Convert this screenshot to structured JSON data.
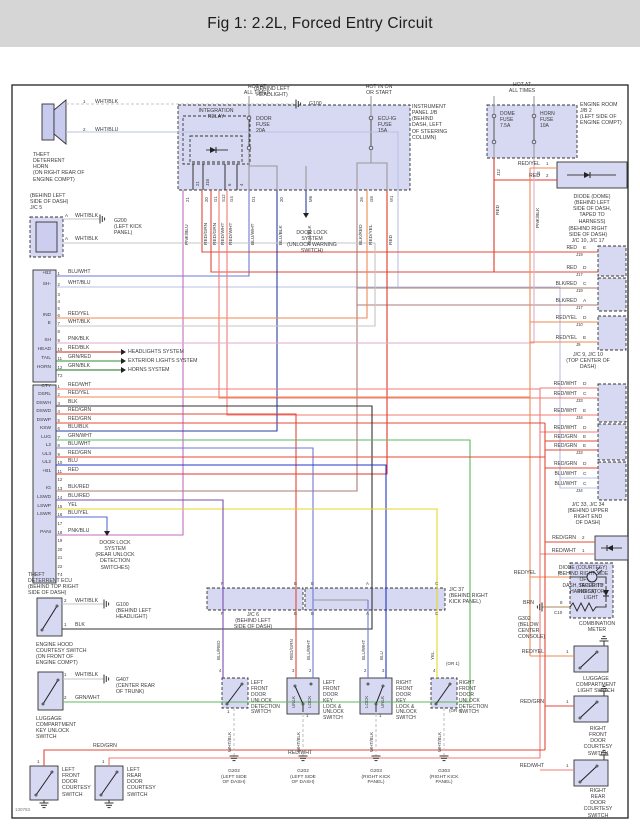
{
  "header": {
    "title": "Fig 1: 2.2L, Forced Entry Circuit"
  },
  "palette": {
    "RED": "#e03828",
    "RED_YEL": "#ef8a54",
    "RED_WHT": "#f27b72",
    "RED_GRN": "#e04838",
    "RED_BLK": "#c02818",
    "BLK_RED": "#ab7b76",
    "WHT_BLK": "#c4c4c4",
    "WHT_BLU": "#b9c2e2",
    "BLU_WHT": "#6b79d8",
    "BLU_BLK": "#2e3e9e",
    "BLU": "#2334c8",
    "BLU_RED": "#7a4fb2",
    "BLU_YEL": "#5a6ad0",
    "PNK_BLK": "#e2aec8",
    "PNK_BLU": "#c06ec0",
    "GRN_RED": "#2e8b2e",
    "GRN_BLK": "#1e6e1e",
    "GRN_WHT": "#5cb85c",
    "YEL": "#e8d428",
    "BLK": "#333333",
    "BRN": "#a88858",
    "GRY": "#9a9a9a",
    "DRK": "#444444",
    "boxfill": "#c9cbee",
    "frame": "#222222"
  },
  "diagram": {
    "code": "130793",
    "texts": {
      "t_horn": "THEFT\nDETERRENT\nHORN\n(ON RIGHT REAR OF\nENGINE COMPT)",
      "g100a_loc": "(BEHIND LEFT\nHEADLIGHT)",
      "g100a": "G100",
      "horn_p1": "1",
      "w_horn1": "WHT/BLK",
      "horn_p2": "2",
      "w_horn2": "WHT/BLU",
      "hot_door": "HOT AT\nALL TIMES",
      "hot_ecuig": "HOT IN ON\nOR START",
      "hot_dome": "HOT AT\nALL TIMES",
      "integ_relay": "INTEGRATION\nRELAY",
      "door_fuse": "DOOR\nFUSE\n20A",
      "ecuig_fuse": "ECU-IG\nFUSE\n15A",
      "dome_fuse": "DOME\nFUSE\n7.5A",
      "horn_fuse": "HORN\nFUSE\n10A",
      "ip_jb": "INSTRUMENT\nPANEL J/B\n(BEHIND\nDASH, LEFT\nOF STEERING\nCOLUMN)",
      "er_jb": "ENGINE ROOM\nJ/B 2\n(LEFT SIDE OF\nENGINE COMPT)",
      "dls1": "DOOR LOCK\nSYSTEM\n(UNLOCK WARNING\nSWITCH)",
      "dd_w1": "RED/YEL",
      "dd_p1": "1",
      "dd_w2": "RED",
      "dd_p2": "2",
      "diode_dome_lbl": "DIODE (DOME)\n(BEHIND LEFT\nSIDE OF DASH,\nTAPED TO\nHARNESS)",
      "brs_label": "(BEHIND RIGHT\nSIDE OF DASH)\nJ/C 10, J/C 17",
      "jc910_lbl": "J/C 9, J/C 10\n(TOP CENTER OF DASH)",
      "jc3334_lbl": "J/C 33, J/C 34\n(BEHIND UPPER\nRIGHT END\nOF DASH)",
      "dc_w1": "RED/GRN",
      "dc_p1": "2",
      "dc_w2": "RED/WHT",
      "dc_p2": "1",
      "dc_lbl": "DIODE (COURTESY)\n(BEHIND RIGHT SIDE OF\nDASH, TAPED TO HARNESS)",
      "sec_light": "SECURITY\nINDICATOR\nLIGHT",
      "comb_meter": "COMBINATION\nMETER",
      "sl_w": "RED/YEL",
      "sl_p": "9",
      "brn_w": "BRN",
      "brn_p": "8",
      "c10": "C10",
      "g302_lbl": "G302\n(BELOW\nCENTER\nCONSOLE)",
      "lls_w": "RED/YEL",
      "lls_p": "1",
      "lls_lbl": "LUGGAGE\nCOMPARTMENT\nLIGHT SWITCH",
      "rfc_w": "RED/GRN",
      "rfc_p": "1",
      "rfc_lbl": "RIGHT\nFRONT\nDOOR\nCOURTESY\nSWITCH",
      "rrc_w": "RED/WHT",
      "rrc_p": "1",
      "rrc_lbl": "RIGHT\nREAR\nDOOR\nCOURTESY\nSWITCH",
      "jc5_lbl": "(BEHIND LEFT\nSIDE OF DASH)\nJ/C 5",
      "jc5_p1": "A",
      "jc5_w1": "WHT/BLK",
      "g200_lbl": "G200\n(LEFT KICK\nPANEL)",
      "jc5_p2": "A",
      "jc5_w2": "WHT/BLK",
      "hl_sys": "HEADLIGHTS SYSTEM",
      "ext_sys": "EXTERIOR LIGHTS SYSTEM",
      "horn_sys": "HORNS SYSTEM",
      "dls2": "DOOR LOCK\nSYSTEM\n(REAR UNLOCK\nDETECTION\nSWITCHES)",
      "ecu_lbl": "THEFT\nDETERRENT ECU\n(BEHIND TOP RIGHT\nSIDE OF DASH)",
      "hood_p2": "2",
      "hood_w2": "WHT/BLK",
      "g100b_lbl": "G100\n(BEHIND LEFT\nHEADLIGHT)",
      "hood_p1": "1",
      "hood_w1": "BLK",
      "hood_lbl": "ENGINE HOOD\nCOURTESY SWITCH\n(ON FRONT OF\nENGINE COMPT)",
      "lugk_p1": "1",
      "lugk_w1": "WHT/BLK",
      "g407_lbl": "G407\n(CENTER REAR\nOF TRUNK)",
      "lugk_p2": "2",
      "lugk_w2": "GRN/WHT",
      "lugk_lbl": "LUGGAGE\nCOMPARTMENT\nKEY UNLOCK\nSWITCH",
      "rg_b": "RED/GRN",
      "rw_b": "RED/WHT",
      "lfc_p": "1",
      "lfc_lbl": "LEFT\nFRONT\nDOOR\nCOURTESY\nSWITCH",
      "lrc_p": "1",
      "lrc_lbl": "LEFT\nREAR\nDOOR\nCOURTESY\nSWITCH",
      "jc6_lbl": "J/C 6\n(BEHIND LEFT\nSIDE OF DASH)",
      "jc37_lbl": "J/C 37\n(BEHIND RIGHT\nKICK PANEL)",
      "or1": "(OR 1)",
      "or4": "(OR 4)",
      "det1_lbl": "LEFT\nFRONT\nDOOR\nUNLOCK\nDETECTION\nSWITCH",
      "key1_lbl": "LEFT\nFRONT\nDOOR\nKEY\nLOCK &\nUNLOCK\nSWITCH",
      "key2_lbl": "RIGHT\nFRONT\nDOOR\nKEY\nLOCK &\nUNLOCK\nSWITCH",
      "det2_lbl": "RIGHT\nFRONT\nDOOR\nUNLOCK\nDETECTION\nSWITCH",
      "det1_p": "1",
      "key1_p": "1",
      "key2_p": "1",
      "unlk1": "UNLK",
      "lock1": "LOCK",
      "lock2": "LOCK",
      "unlk2": "UNLK",
      "g202a_lbl": "G202\n(LEFT SIDE\nOF DASH)",
      "g202b_lbl": "G202\n(LEFT SIDE\nOF DASH)",
      "g203_lbl": "G203\n(RIGHT KICK\nPANEL)",
      "g303_lbl": "G303\n(RIGHT KICK\nPANEL)"
    },
    "jb": {
      "relay_pins": [
        "21",
        "J18",
        "6",
        "4"
      ],
      "exits": [
        {
          "pin": "21",
          "wire": "PNK/BLU"
        },
        {
          "pin": "20",
          "wire": "RED/GRN"
        },
        {
          "pin": "G1",
          "wire": "RED/GRN"
        },
        {
          "pin": "S12",
          "wire": "RED/WHT"
        },
        {
          "pin": "G4",
          "wire": "RED/WHT"
        },
        {
          "pin": "D1",
          "wire": "BLU/WHT"
        },
        {
          "pin": "20",
          "wire": "BLU/BLK"
        },
        {
          "pin": "M6",
          "wire": "BLU/BLK"
        },
        {
          "pin": "26",
          "wire": "BLK/RED"
        },
        {
          "pin": "G8",
          "wire": "RED/YEL"
        },
        {
          "pin": "W1",
          "wire": "RED"
        }
      ]
    },
    "er": {
      "exits": [
        {
          "pin": "J12",
          "wire": "RED"
        },
        {
          "pin": "12",
          "wire": "PNK/BLK"
        }
      ]
    },
    "ecu": {
      "conn1": [
        {
          "n": "1",
          "name": "+B2",
          "wire": "BLU/WHT"
        },
        {
          "n": "2",
          "name": "SH-",
          "wire": "WHT/BLU"
        },
        {
          "n": "3"
        },
        {
          "n": "4"
        },
        {
          "n": "5"
        },
        {
          "n": "6",
          "name": "IND",
          "wire": "RED/YEL"
        },
        {
          "n": "7",
          "name": "E",
          "wire": "WHT/BLK"
        },
        {
          "n": "8"
        },
        {
          "n": "9",
          "name": "SH",
          "wire": "PNK/BLK"
        },
        {
          "n": "10",
          "name": "HEAD",
          "wire": "RED/BLK"
        },
        {
          "n": "11",
          "name": "TAIL",
          "wire": "GRN/RED"
        },
        {
          "n": "12",
          "name": "HORN",
          "wire": "GRN/BLK"
        },
        {
          "n": "T2"
        }
      ],
      "conn2": [
        {
          "n": "1",
          "name": "CTY",
          "wire": "RED/WHT"
        },
        {
          "n": "2",
          "name": "DSRL",
          "wire": "RED/YEL"
        },
        {
          "n": "3",
          "name": "DSWH",
          "wire": "BLK"
        },
        {
          "n": "4",
          "name": "DSWD",
          "wire": "RED/GRN"
        },
        {
          "n": "5",
          "name": "DSWP",
          "wire": "RED/GRN"
        },
        {
          "n": "6",
          "name": "KSW",
          "wire": "BLU/BLK"
        },
        {
          "n": "7",
          "name": "LUG",
          "wire": "GRN/WHT"
        },
        {
          "n": "8",
          "name": "L2",
          "wire": "BLU/WHT"
        },
        {
          "n": "9",
          "name": "UL3",
          "wire": "RED/GRN"
        },
        {
          "n": "10",
          "name": "UL2",
          "wire": "BLU"
        },
        {
          "n": "11",
          "name": "+B1",
          "wire": "RED"
        },
        {
          "n": "12"
        },
        {
          "n": "13",
          "name": "IG",
          "wire": "BLK/RED"
        },
        {
          "n": "14",
          "name": "LSWD",
          "wire": "BLU/RED"
        },
        {
          "n": "15",
          "name": "LSWP",
          "wire": "YEL"
        },
        {
          "n": "16",
          "name": "LSWR",
          "wire": "BLU/YEL"
        },
        {
          "n": "17"
        },
        {
          "n": "18",
          "name": "PANI",
          "wire": "PNK/BLU"
        },
        {
          "n": "19"
        },
        {
          "n": "20"
        },
        {
          "n": "21"
        },
        {
          "n": "22"
        },
        {
          "n": "T4"
        }
      ]
    },
    "right": {
      "jc1017": [
        {
          "wire": "RED",
          "pin": "E",
          "tag": "J19"
        },
        {
          "wire": "RED",
          "pin": "D",
          "tag": "J17"
        },
        {
          "wire": "BLK/RED",
          "pin": "C",
          "tag": "J19"
        },
        {
          "wire": "BLK/RED",
          "pin": "A",
          "tag": "J17"
        }
      ],
      "jc910": [
        {
          "wire": "RED/YEL",
          "pin": "D",
          "tag": "J10"
        },
        {
          "wire": "RED/YEL",
          "pin": "E",
          "tag": "J9"
        }
      ],
      "jc3334": [
        {
          "wire": "RED/WHT",
          "pin": "D"
        },
        {
          "wire": "RED/WHT",
          "pin": "C",
          "tag": "J33"
        },
        {
          "wire": "RED/WHT",
          "pin": "E",
          "tag": "J34"
        },
        {
          "wire": "RED/WHT",
          "pin": "D"
        },
        {
          "wire": "RED/GRN",
          "pin": "E"
        },
        {
          "wire": "RED/GRN",
          "pin": "E",
          "tag": "J33"
        },
        {
          "wire": "RED/GRN",
          "pin": "D"
        },
        {
          "wire": "BLU/WHT",
          "pin": "C"
        },
        {
          "wire": "BLU/WHT",
          "pin": "C",
          "tag": "J34"
        }
      ]
    },
    "mid": {
      "wires": [
        "BLU/RED",
        "RED/GRN",
        "BLU/WHT",
        "BLU/WHT",
        "BLU",
        "YEL"
      ],
      "pins": [
        "4",
        "3",
        "2",
        "2",
        "3",
        "4"
      ],
      "jc6_pins": [
        "F",
        "B"
      ],
      "jc37_pins": [
        "B",
        "A",
        "C"
      ],
      "whtblk": "WHT/BLK"
    }
  }
}
